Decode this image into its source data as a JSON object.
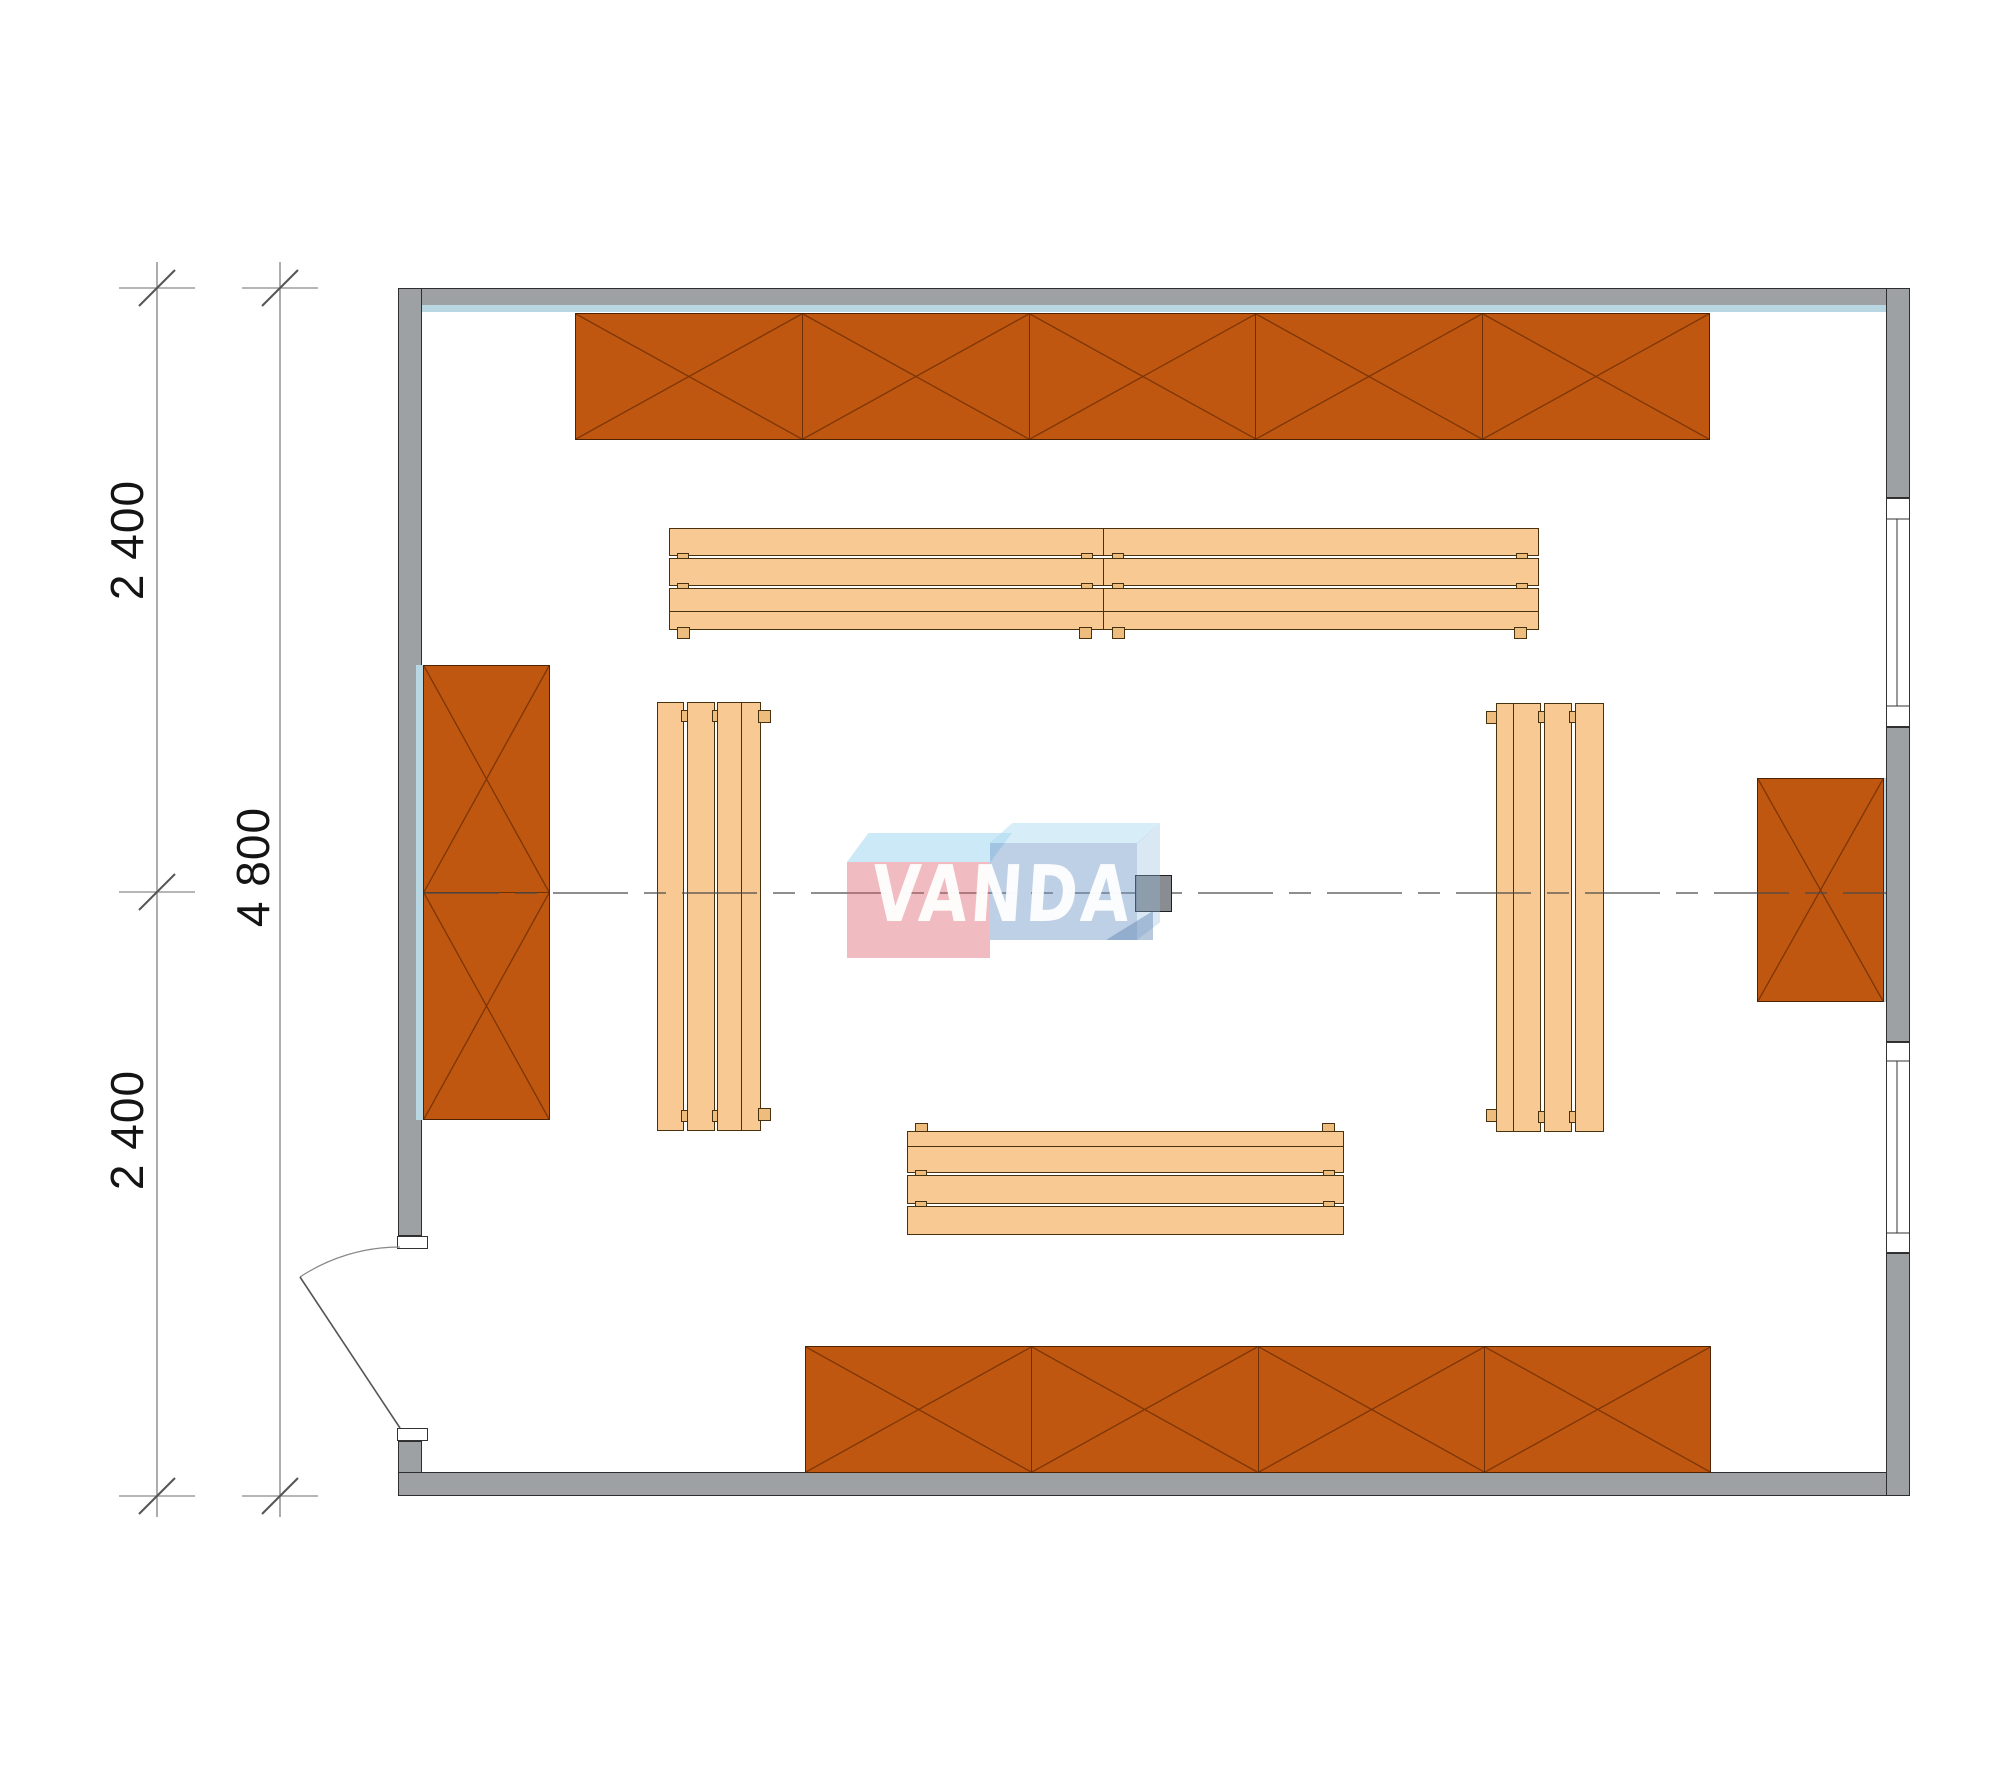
{
  "drawing": {
    "kind": "sauna-room floor plan",
    "dims": {
      "top": "2 400",
      "overall": "4 800",
      "bottom": "2 400"
    },
    "watermark": {
      "text": "VANDA",
      "pink": "#e25f6c",
      "blue": "#6e96c8",
      "cyan": "#a0d7f0"
    },
    "colors": {
      "wall": "#9ea1a4",
      "cabinet": "#bf5710",
      "bench": "#f8c992",
      "wall_lining": "#b9d6e3"
    },
    "cabinets": [
      {
        "id": "top",
        "sections": 5
      },
      {
        "id": "left",
        "sections": 2
      },
      {
        "id": "right",
        "sections": 1
      },
      {
        "id": "bottom",
        "sections": 4
      }
    ],
    "benches": [
      {
        "id": "upper-left"
      },
      {
        "id": "upper-right"
      },
      {
        "id": "left"
      },
      {
        "id": "right"
      },
      {
        "id": "bottom"
      }
    ],
    "openings": [
      {
        "id": "door-left-bottom"
      },
      {
        "id": "window-right-upper"
      },
      {
        "id": "window-right-lower"
      }
    ]
  }
}
